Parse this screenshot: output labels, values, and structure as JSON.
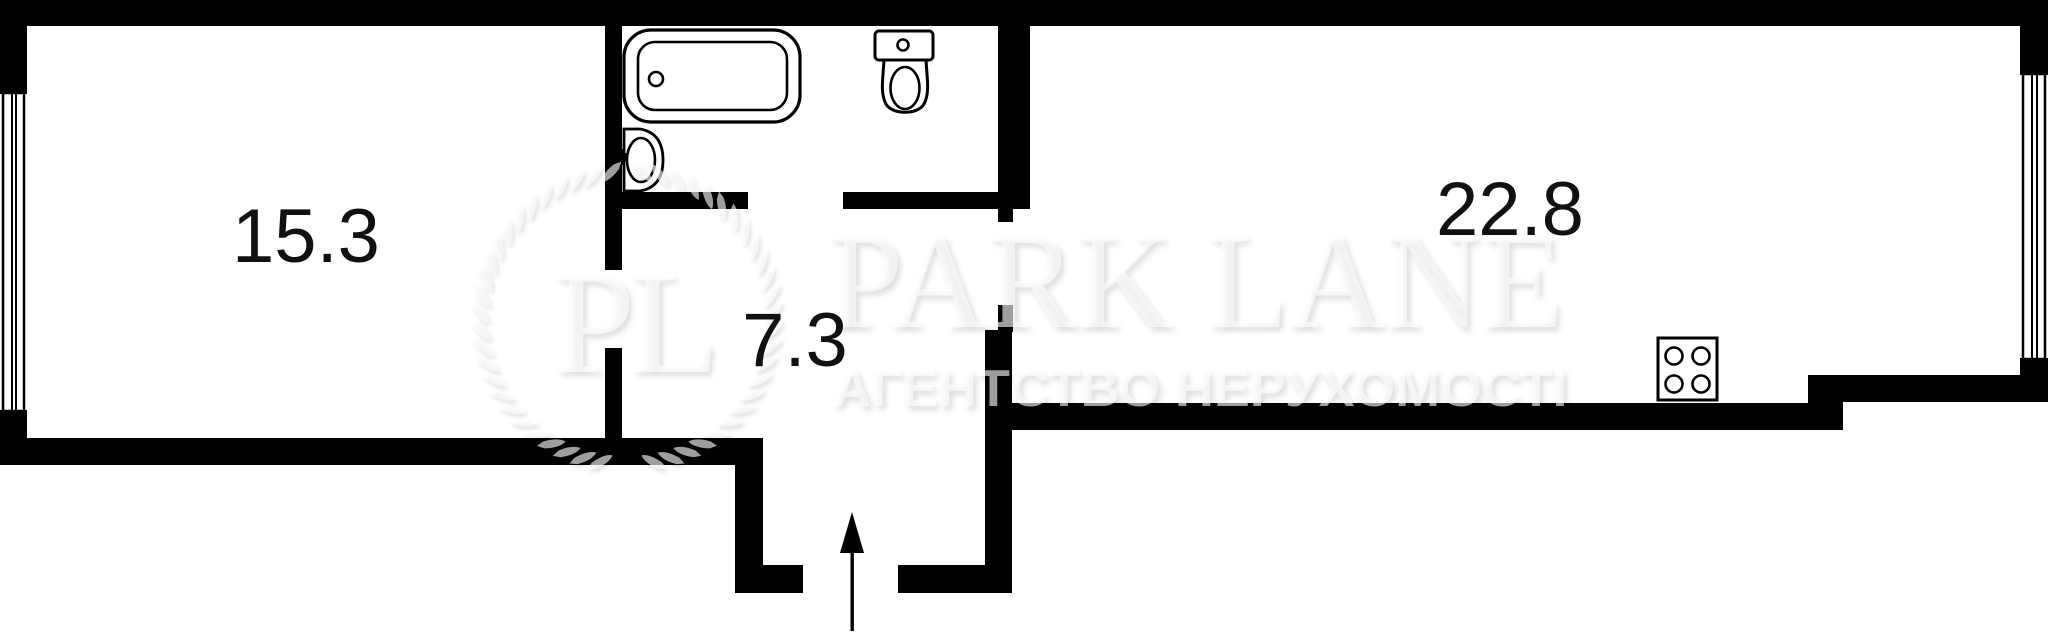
{
  "plan_type": "apartment-floor-plan",
  "rooms": [
    {
      "name": "living-room",
      "area": "15.3"
    },
    {
      "name": "hallway",
      "area": "7.3"
    },
    {
      "name": "kitchen-living-room",
      "area": "22.8"
    }
  ],
  "fixtures": [
    "bathtub-icon",
    "sink-icon",
    "toilet-icon",
    "stove-4-burner-icon",
    "window-symbol-left",
    "window-symbol-right",
    "entrance-arrow-up"
  ],
  "watermark": {
    "monogram": "PL",
    "brand": "PARK LANE",
    "tagline": "АГЕНТСТВО НЕРУХОМОСТІ"
  },
  "colors": {
    "wall": "#000000",
    "background": "#ffffff",
    "room_label": "#111111",
    "watermark": "#f2f2f2"
  }
}
